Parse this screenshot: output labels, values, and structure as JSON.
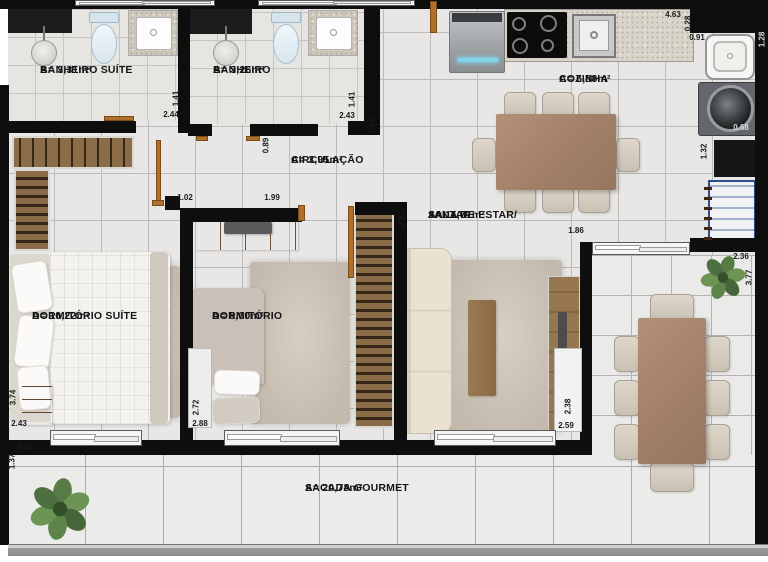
{
  "plan": {
    "type": "apartment-floor-plan",
    "colors": {
      "wall": "#0e0e0e",
      "floor": "#e8e7e5",
      "tile_line": "#bcbbb9",
      "wood": "#8f6f4c",
      "door": "#b06f2a",
      "rug": "#c9c0b5",
      "sofa": "#eae3d3",
      "dining_table": "#a8846d",
      "plant": "#5d7d49",
      "railing": "#9b9b9b"
    }
  },
  "rooms": {
    "banheiro_suite": {
      "name": "BANHEIRO SUÍTE",
      "area": "A= 3,31m²"
    },
    "banheiro": {
      "name": "BANHEIRO",
      "area": "A= 3,26m²"
    },
    "cozinha": {
      "name": "COZINHA",
      "area": "A= 6,88m²"
    },
    "circulacao": {
      "name": "CIRCULAÇÃO",
      "area": "A= 3,95m²"
    },
    "sala": {
      "name_line1": "SALA DE ESTAR/",
      "name_line2": "JANTAR",
      "area": "A= 11,71m²"
    },
    "dormitorio_suite": {
      "name": "DORMITÓRIO SUÍTE",
      "area": "A= 10,22m²"
    },
    "dormitorio": {
      "name": "DORMITÓRIO",
      "area": "A= 8,00m²"
    },
    "sacada": {
      "name": "SACADA GOURMET",
      "area": "A= 20,78m²"
    }
  },
  "dimensions": [
    {
      "id": "kitchen-width",
      "value": "4.63"
    },
    {
      "id": "kitchen-wall-offset",
      "value": "0.28"
    },
    {
      "id": "service-width",
      "value": "0.91"
    },
    {
      "id": "banheiro-suite-depth",
      "value": "1.41"
    },
    {
      "id": "banheiro-suite-width",
      "value": "2.44"
    },
    {
      "id": "banheiro-depth",
      "value": "1.41"
    },
    {
      "id": "banheiro-width",
      "value": "2.43"
    },
    {
      "id": "banheiro-side",
      "value": "1.54"
    },
    {
      "id": "circulacao-width",
      "value": "0.89"
    },
    {
      "id": "hall-segment-a",
      "value": "1.02"
    },
    {
      "id": "hall-segment-b",
      "value": "1.99"
    },
    {
      "id": "sala-side",
      "value": "2.81"
    },
    {
      "id": "sala-window",
      "value": "1.86"
    },
    {
      "id": "service-depth",
      "value": "1.32"
    },
    {
      "id": "washer-width",
      "value": "0.68"
    },
    {
      "id": "service-edge",
      "value": "1.28"
    },
    {
      "id": "terrace-width",
      "value": "2.36"
    },
    {
      "id": "terrace-depth",
      "value": "3.77"
    },
    {
      "id": "dorm-suite-depth",
      "value": "3.74"
    },
    {
      "id": "dorm-suite-width",
      "value": "2.43"
    },
    {
      "id": "sacada-width",
      "value": "8.30"
    },
    {
      "id": "sacada-depth",
      "value": "1.37"
    },
    {
      "id": "dormitorio-depth",
      "value": "2.72"
    },
    {
      "id": "dormitorio-width",
      "value": "2.88"
    },
    {
      "id": "sala-depth",
      "value": "2.38"
    },
    {
      "id": "sala-width",
      "value": "2.59"
    }
  ]
}
